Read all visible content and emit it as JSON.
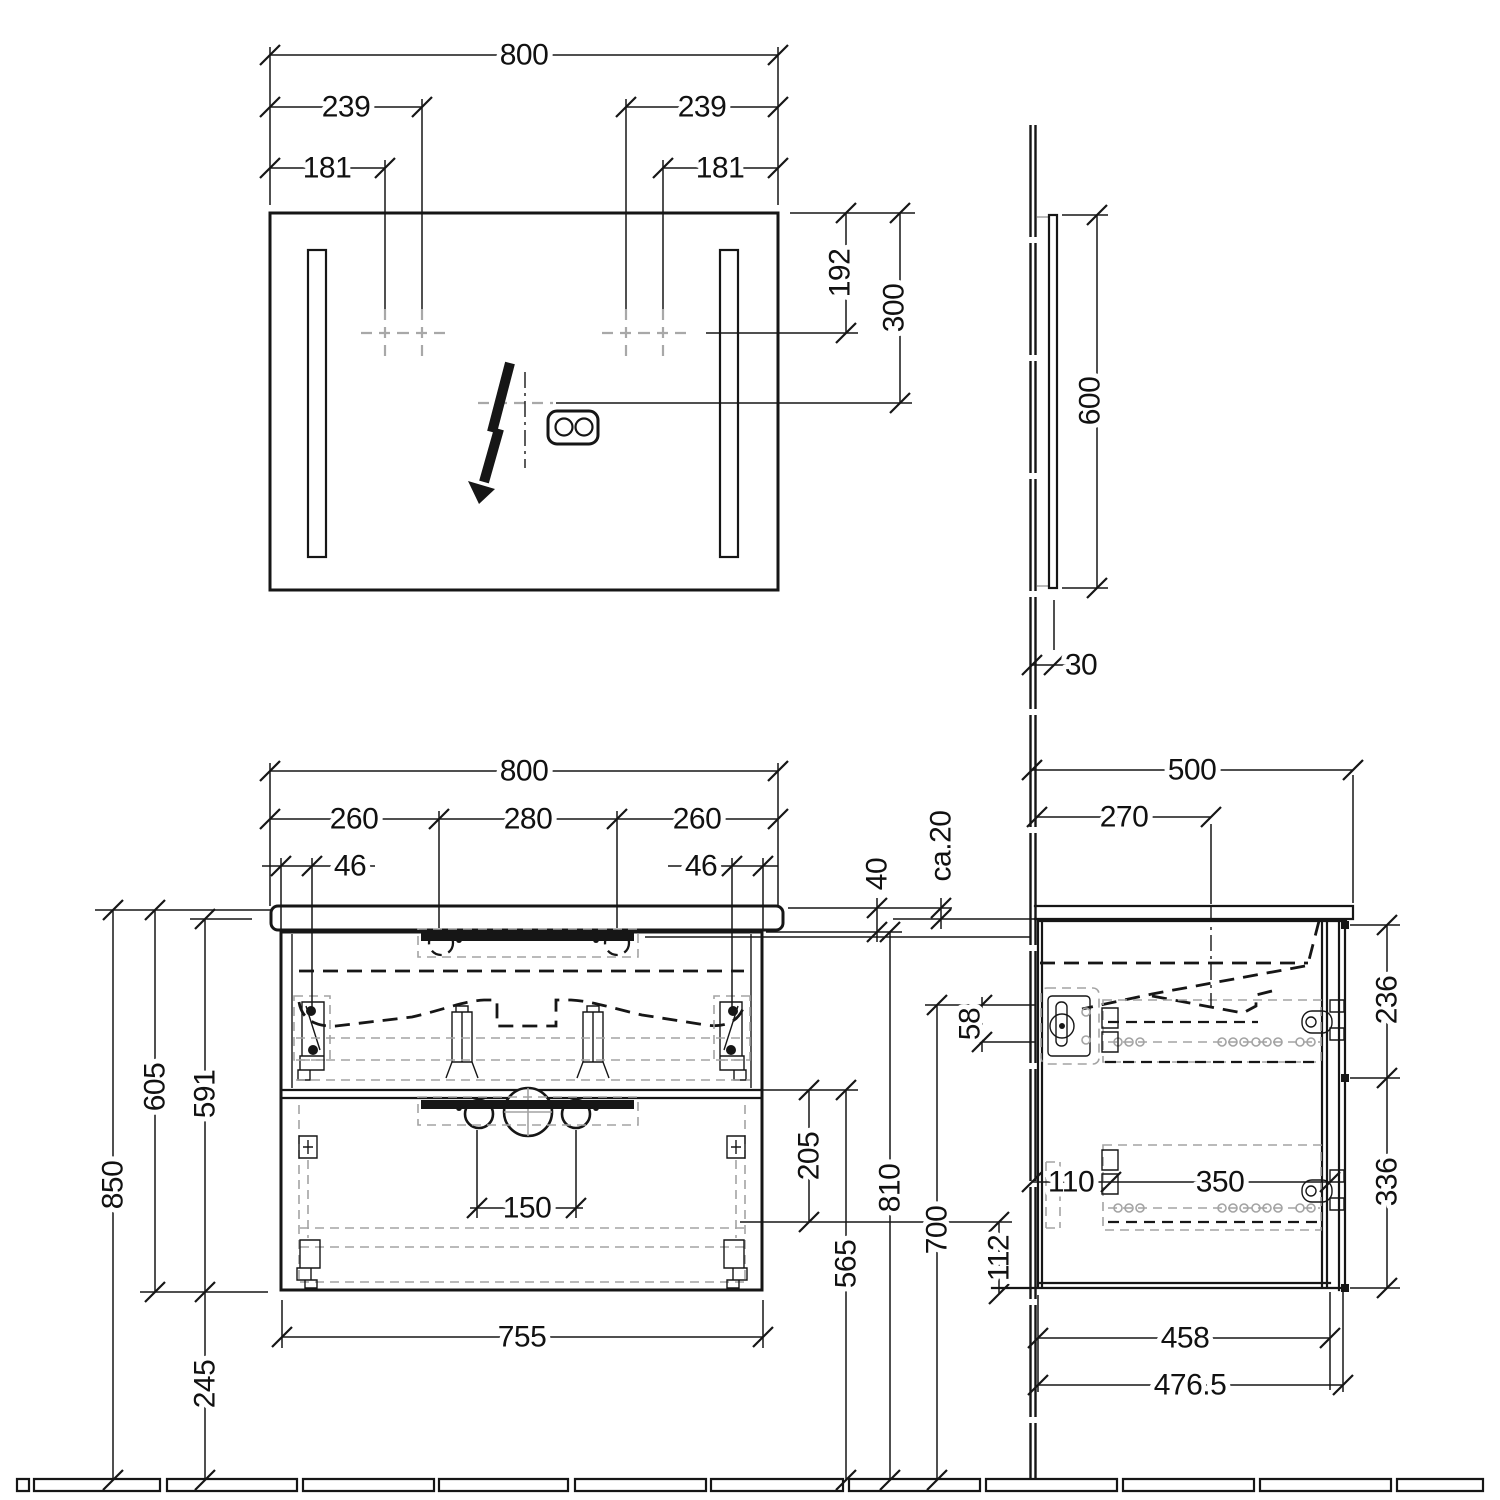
{
  "drawing": {
    "kind": "bathroom furniture installation drawing",
    "units": "mm",
    "mirror_front": {
      "width": "800",
      "left_239": "239",
      "right_239": "239",
      "left_181": "181",
      "right_181": "181",
      "lamp_drop": "192",
      "socket_drop": "300"
    },
    "mirror_side": {
      "height": "600",
      "depth": "30"
    },
    "vanity_front": {
      "width": "800",
      "seg_left": "260",
      "seg_mid": "280",
      "seg_right": "260",
      "inset_left": "46",
      "inset_right": "46",
      "top_thickness": "40",
      "gap": "ca.20",
      "h58": "58",
      "total_height": "850",
      "h605": "605",
      "h591": "591",
      "clearance": "245",
      "drain_span": "150",
      "h205": "205",
      "h565": "565",
      "h810": "810",
      "h700": "700",
      "h112": "112",
      "body_width": "755"
    },
    "vanity_side": {
      "depth": "500",
      "faucet_center": "270",
      "upper_front": "236",
      "lower_front": "336",
      "d110": "110",
      "d350": "350",
      "d458": "458",
      "d476_5": "476.5"
    }
  }
}
